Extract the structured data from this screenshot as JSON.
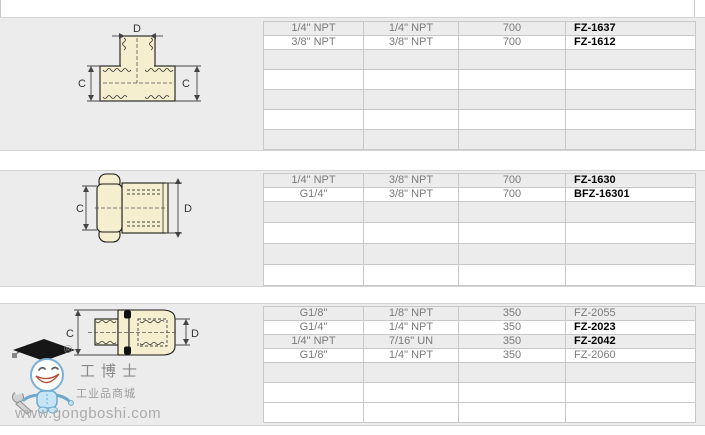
{
  "colors": {
    "section_bg": "#ececec",
    "row_white": "#ffffff",
    "table_border": "#c8c8c8",
    "table_text": "#7a7a7a",
    "part_number_bold": "#000000",
    "drawing_fill": "#f6efcf",
    "mascot_blue": "#c6e6f8"
  },
  "watermark": {
    "registered": "®",
    "brand": "工博士",
    "brand_sub": "工业品商城",
    "url": "www.gongboshi.com"
  },
  "sections": [
    {
      "drawing": "tee-fitting",
      "dim_c": "C",
      "dim_d": "D",
      "rows": [
        {
          "cells": [
            "1/4\" NPT",
            "1/4\" NPT",
            "700",
            "FZ-1637"
          ],
          "bold": true
        },
        {
          "cells": [
            "3/8\" NPT",
            "3/8\" NPT",
            "700",
            "FZ-1612"
          ],
          "bold": true
        },
        {
          "cells": [
            "",
            "",
            "",
            ""
          ],
          "bold": false
        },
        {
          "cells": [
            "",
            "",
            "",
            ""
          ],
          "bold": false
        },
        {
          "cells": [
            "",
            "",
            "",
            ""
          ],
          "bold": false
        },
        {
          "cells": [
            "",
            "",
            "",
            ""
          ],
          "bold": false
        },
        {
          "cells": [
            "",
            "",
            "",
            ""
          ],
          "bold": false
        }
      ]
    },
    {
      "drawing": "hex-bushing-fitting",
      "dim_c": "C",
      "dim_d": "D",
      "rows": [
        {
          "cells": [
            "1/4\" NPT",
            "3/8\" NPT",
            "700",
            "FZ-1630"
          ],
          "bold": true
        },
        {
          "cells": [
            "G1/4\"",
            "3/8\" NPT",
            "700",
            "BFZ-16301"
          ],
          "bold": true
        },
        {
          "cells": [
            "",
            "",
            "",
            ""
          ],
          "bold": false
        },
        {
          "cells": [
            "",
            "",
            "",
            ""
          ],
          "bold": false
        },
        {
          "cells": [
            "",
            "",
            "",
            ""
          ],
          "bold": false
        },
        {
          "cells": [
            "",
            "",
            "",
            ""
          ],
          "bold": false
        }
      ]
    },
    {
      "drawing": "male-female-adapter",
      "dim_c": "C",
      "dim_d": "D",
      "rows": [
        {
          "cells": [
            "G1/8\"",
            "1/8\" NPT",
            "350",
            "FZ-2055"
          ],
          "bold": false
        },
        {
          "cells": [
            "G1/4\"",
            "1/4\" NPT",
            "350",
            "FZ-2023"
          ],
          "bold": true
        },
        {
          "cells": [
            "1/4\" NPT",
            "7/16\" UN",
            "350",
            "FZ-2042"
          ],
          "bold": true
        },
        {
          "cells": [
            "G1/8\"",
            "1/4\" NPT",
            "350",
            "FZ-2060"
          ],
          "bold": false
        },
        {
          "cells": [
            "",
            "",
            "",
            ""
          ],
          "bold": false
        },
        {
          "cells": [
            "",
            "",
            "",
            ""
          ],
          "bold": false
        },
        {
          "cells": [
            "",
            "",
            "",
            ""
          ],
          "bold": false
        }
      ]
    }
  ]
}
